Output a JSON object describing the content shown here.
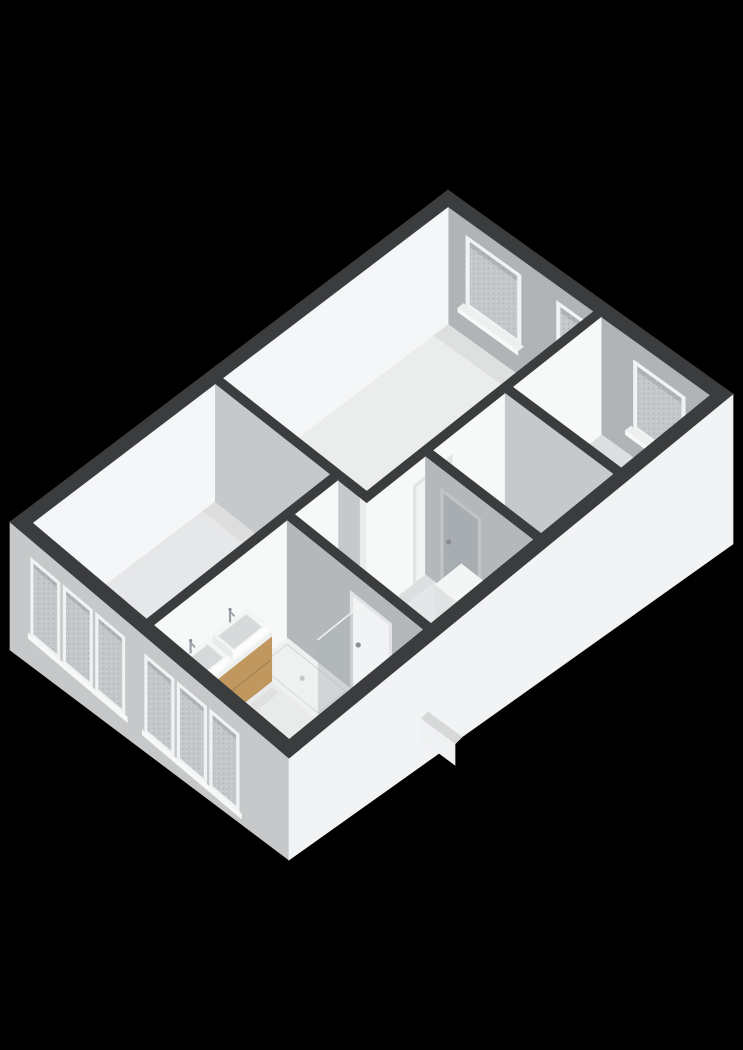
{
  "meta": {
    "view_label": "3d-floorplan-render",
    "background": "#000000"
  },
  "palette": {
    "capDark": "#3a3c3e",
    "rearInner": "#b1b4b7",
    "leftInner": "#f5f6f7",
    "faceWhite": "#f7f8f8",
    "faceGrayLight": "#c6c9cb",
    "faceGrayMid": "#b4b8bb",
    "floorA": "#ebecec",
    "floorB": "#e9eaeb",
    "floorC": "#e6e7e8",
    "floorHall": "#e4e6e7",
    "floorBath": "#e9eaea",
    "floorStair": "#dfe1e2",
    "tray": "#eff0f0",
    "trayLine": "#d5d8d9",
    "doorWhite": "#f2f3f4",
    "doorGray": "#a8adb1",
    "doorFrame": "#e2e4e5",
    "doorFrameGray": "#c0c4c7",
    "windowFrame": "#f1f2f3",
    "glass": "#c3c7c9",
    "sillTop": "#eef0f0",
    "sillFace": "#f7f8f8",
    "facadeFront": "#c6c8ca",
    "facadeRight": "#f2f3f4",
    "wood": "#c0975f",
    "woodDark": "#9f7a4c",
    "woodSeam": "#8f6c40",
    "counterLip": "#eef0f0",
    "counterEnd": "#e4e6e6",
    "basinRim": "#f4f6f6",
    "basinInner": "#d7dadb",
    "basinLipFront": "#fdfdfd",
    "basinLipSide": "#e9ebeb",
    "chrome": "#9aa0a5",
    "chromeDark": "#878d92",
    "showerGlass": "#aeb4b8",
    "glassEdge": "#eef0f1",
    "ductTop": "#f4f5f5",
    "ductFront": "#e0e2e3",
    "ductSide": "#eceeef",
    "wedgeTop": "#d6d8d9",
    "wedgeFace": "#f0f1f2",
    "ao": "#6e7376"
  },
  "projection": {
    "corners": {
      "L": [
        10,
        522
      ],
      "T": [
        448,
        190
      ],
      "R": [
        733,
        394
      ],
      "B": [
        289,
        758
      ]
    },
    "plan": [
      548,
      352
    ],
    "floor_drop": 118,
    "facade_front_drop": [
      128,
      102
    ],
    "facade_right_drop": [
      102,
      150
    ],
    "ext_wall": 14
  },
  "floors": [
    {
      "name": "floor-bedroom-rear-left",
      "color": "floorA",
      "poly": [
        [
          252,
          14
        ],
        [
          534,
          14
        ],
        [
          534,
          194
        ],
        [
          252,
          194
        ]
      ]
    },
    {
      "name": "floor-bedroom-front-left",
      "color": "floorC",
      "poly": [
        [
          14,
          14
        ],
        [
          243,
          14
        ],
        [
          243,
          158
        ],
        [
          14,
          158
        ]
      ]
    },
    {
      "name": "floor-bedroom-rear-right",
      "color": "floorB",
      "poly": [
        [
          424,
          203
        ],
        [
          534,
          203
        ],
        [
          534,
          338
        ],
        [
          424,
          338
        ]
      ]
    },
    {
      "name": "floor-stairwell",
      "color": "floorStair",
      "poly": [
        [
          325,
          203
        ],
        [
          415,
          203
        ],
        [
          415,
          338
        ],
        [
          325,
          338
        ]
      ]
    },
    {
      "name": "floor-landing",
      "color": "floorHall",
      "poly": [
        [
          189,
          167
        ],
        [
          243,
          167
        ],
        [
          243,
          203
        ],
        [
          316,
          203
        ],
        [
          316,
          338
        ],
        [
          189,
          338
        ]
      ]
    },
    {
      "name": "floor-bathroom",
      "color": "floorBath",
      "poly": [
        [
          14,
          167
        ],
        [
          180,
          167
        ],
        [
          180,
          338
        ],
        [
          14,
          338
        ]
      ]
    }
  ],
  "ao_strips": [
    {
      "rect": [
        516,
        14,
        534,
        194
      ],
      "opacity": 0.1
    },
    {
      "rect": [
        227,
        14,
        243,
        158
      ],
      "opacity": 0.08
    },
    {
      "rect": [
        516,
        203,
        534,
        338
      ],
      "opacity": 0.1
    },
    {
      "rect": [
        14,
        167,
        180,
        181
      ],
      "opacity": 0.07
    },
    {
      "rect": [
        189,
        203,
        316,
        215
      ],
      "opacity": 0.06
    },
    {
      "rect": [
        252,
        182,
        534,
        194
      ],
      "opacity": 0.05
    },
    {
      "rect": [
        28,
        196,
        132,
        205
      ],
      "opacity": 0.07
    }
  ],
  "rear_windows": [
    {
      "name": "rear-window-large",
      "t": [
        36,
        104
      ],
      "d": [
        16,
        86
      ]
    },
    {
      "name": "rear-window-small",
      "t": [
        148,
        190
      ],
      "d": [
        16,
        76
      ]
    },
    {
      "name": "rear-window-bedroom-right",
      "t": [
        243,
        307
      ],
      "d": [
        20,
        88
      ]
    }
  ],
  "front_windows": [
    {
      "name": "front-window-1",
      "t": [
        26,
        63
      ],
      "d": [
        18,
        96
      ]
    },
    {
      "name": "front-window-2",
      "t": [
        67,
        104
      ],
      "d": [
        18,
        96
      ]
    },
    {
      "name": "front-window-3",
      "t": [
        108,
        145
      ],
      "d": [
        18,
        96
      ]
    },
    {
      "name": "front-window-4",
      "t": [
        170,
        207
      ],
      "d": [
        18,
        96
      ]
    },
    {
      "name": "front-window-5",
      "t": [
        211,
        248
      ],
      "d": [
        18,
        96
      ]
    },
    {
      "name": "front-window-6",
      "t": [
        252,
        289
      ],
      "d": [
        18,
        96
      ]
    }
  ],
  "walls": [
    {
      "name": "wall-bedrooms-landing",
      "rect": [
        243,
        194,
        534,
        203
      ],
      "faces": [
        {
          "plane": "T",
          "color": "faceWhite"
        }
      ],
      "door": {
        "name": "door-bedroom-rear-left",
        "plane": "T",
        "span": [
          305,
          345
        ],
        "top": 24,
        "panel": "doorWhite",
        "frame": "doorFrame",
        "handle": 341
      }
    },
    {
      "name": "wall-stair-bedroom-right",
      "rect": [
        415,
        203,
        424,
        338
      ],
      "faces": [
        {
          "plane": "S",
          "color": "faceGrayLight"
        }
      ]
    },
    {
      "name": "wall-front-left-partition",
      "rect": [
        243,
        14,
        252,
        194
      ],
      "faces": [
        {
          "plane": "S",
          "color": "faceGrayLight"
        }
      ]
    },
    {
      "name": "wall-bedroom-bathroom",
      "rect": [
        14,
        158,
        243,
        167
      ],
      "faces": [
        {
          "plane": "T",
          "color": "faceWhite"
        }
      ]
    },
    {
      "name": "wall-stair-landing",
      "rect": [
        316,
        203,
        325,
        338
      ],
      "faces": [
        {
          "plane": "S",
          "color": "faceGrayMid"
        }
      ],
      "door": {
        "name": "door-stairwell",
        "plane": "S",
        "span": [
          226,
          268
        ],
        "top": 24,
        "panel": "doorGray",
        "frame": "doorFrameGray",
        "handle": 232
      }
    },
    {
      "name": "wall-bathroom-landing",
      "rect": [
        180,
        167,
        189,
        338
      ],
      "faces": [
        {
          "plane": "S",
          "color": "faceGrayMid"
        }
      ],
      "door": {
        "name": "door-bathroom",
        "plane": "S",
        "span": [
          250,
          294
        ],
        "top": 24,
        "panel": "doorWhite",
        "frame": "doorFrame",
        "handle": 256
      }
    }
  ],
  "shower": {
    "tray": [
      136,
      167,
      180,
      250
    ],
    "drain": [
      158,
      208
    ],
    "glass": {
      "plane_y": 250,
      "x": [
        136,
        180
      ],
      "d": [
        38,
        118
      ],
      "opacity": 0.45
    }
  },
  "vanity": {
    "body": [
      28,
      167,
      132,
      196
    ],
    "counter_d": 62,
    "lip_d": 68,
    "base_d": 112,
    "seam_d": 90,
    "basins": [
      [
        36,
        169,
        80,
        194
      ],
      [
        86,
        169,
        128,
        194
      ]
    ],
    "basin_rim_d": 54,
    "faucets": [
      [
        58,
        169
      ],
      [
        107,
        169
      ]
    ]
  },
  "duct": {
    "rect": [
      240,
      292,
      272,
      322
    ],
    "top_d": 24
  },
  "roof_wedge": {
    "top": [
      [
        428,
        712
      ],
      [
        462,
        737
      ],
      [
        455,
        744
      ],
      [
        421,
        719
      ]
    ],
    "face": [
      [
        421,
        719
      ],
      [
        455,
        744
      ],
      [
        455,
        765
      ],
      [
        421,
        740
      ]
    ]
  }
}
